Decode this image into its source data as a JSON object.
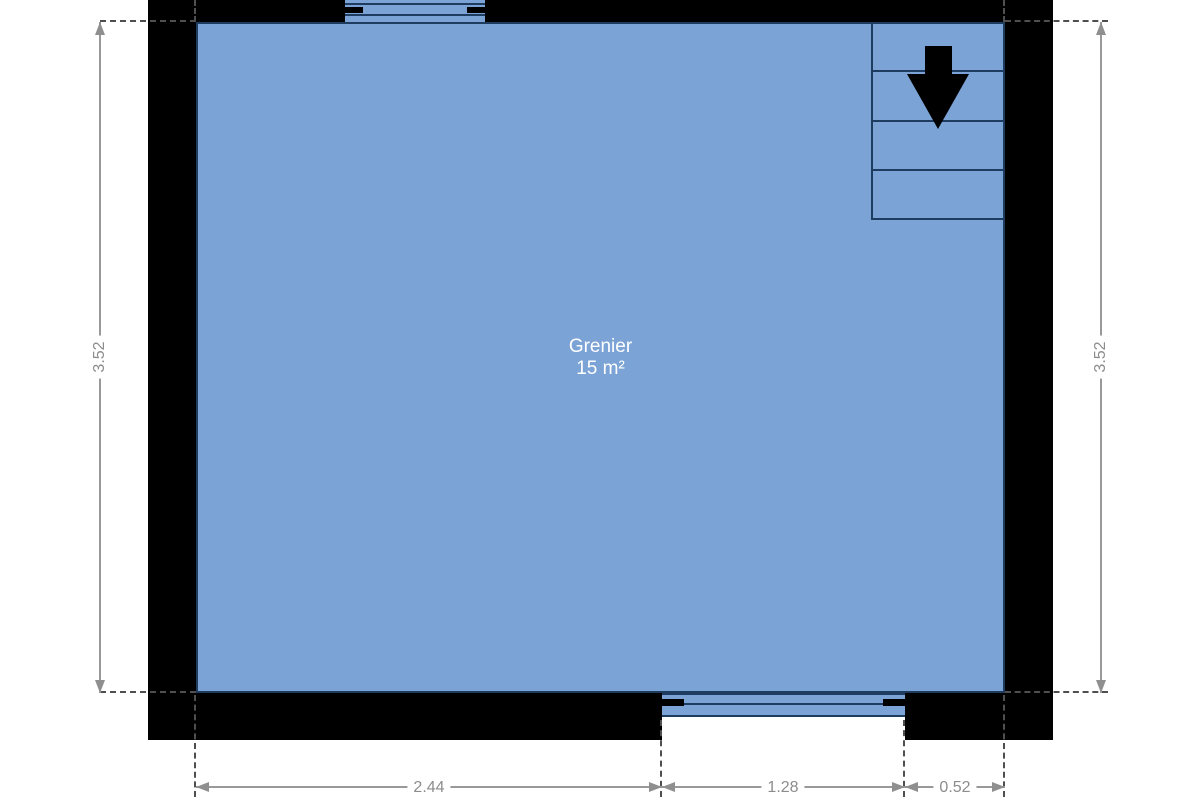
{
  "floor_plan": {
    "room": {
      "name": "Grenier",
      "area": "15 m²"
    },
    "dimensions": {
      "left_height": "3.52",
      "right_height": "3.52",
      "bottom_widths": [
        "2.44",
        "1.28",
        "0.52"
      ]
    },
    "stairs": {
      "treads": 4,
      "arrow_direction": "down"
    },
    "colors": {
      "room_fill": "#7ba3d5",
      "plan_line": "#1d3c60",
      "wall": "#000000",
      "dimension_line": "#999999",
      "dimension_text": "#8c8c8c",
      "room_label_text": "#ffffff"
    }
  }
}
